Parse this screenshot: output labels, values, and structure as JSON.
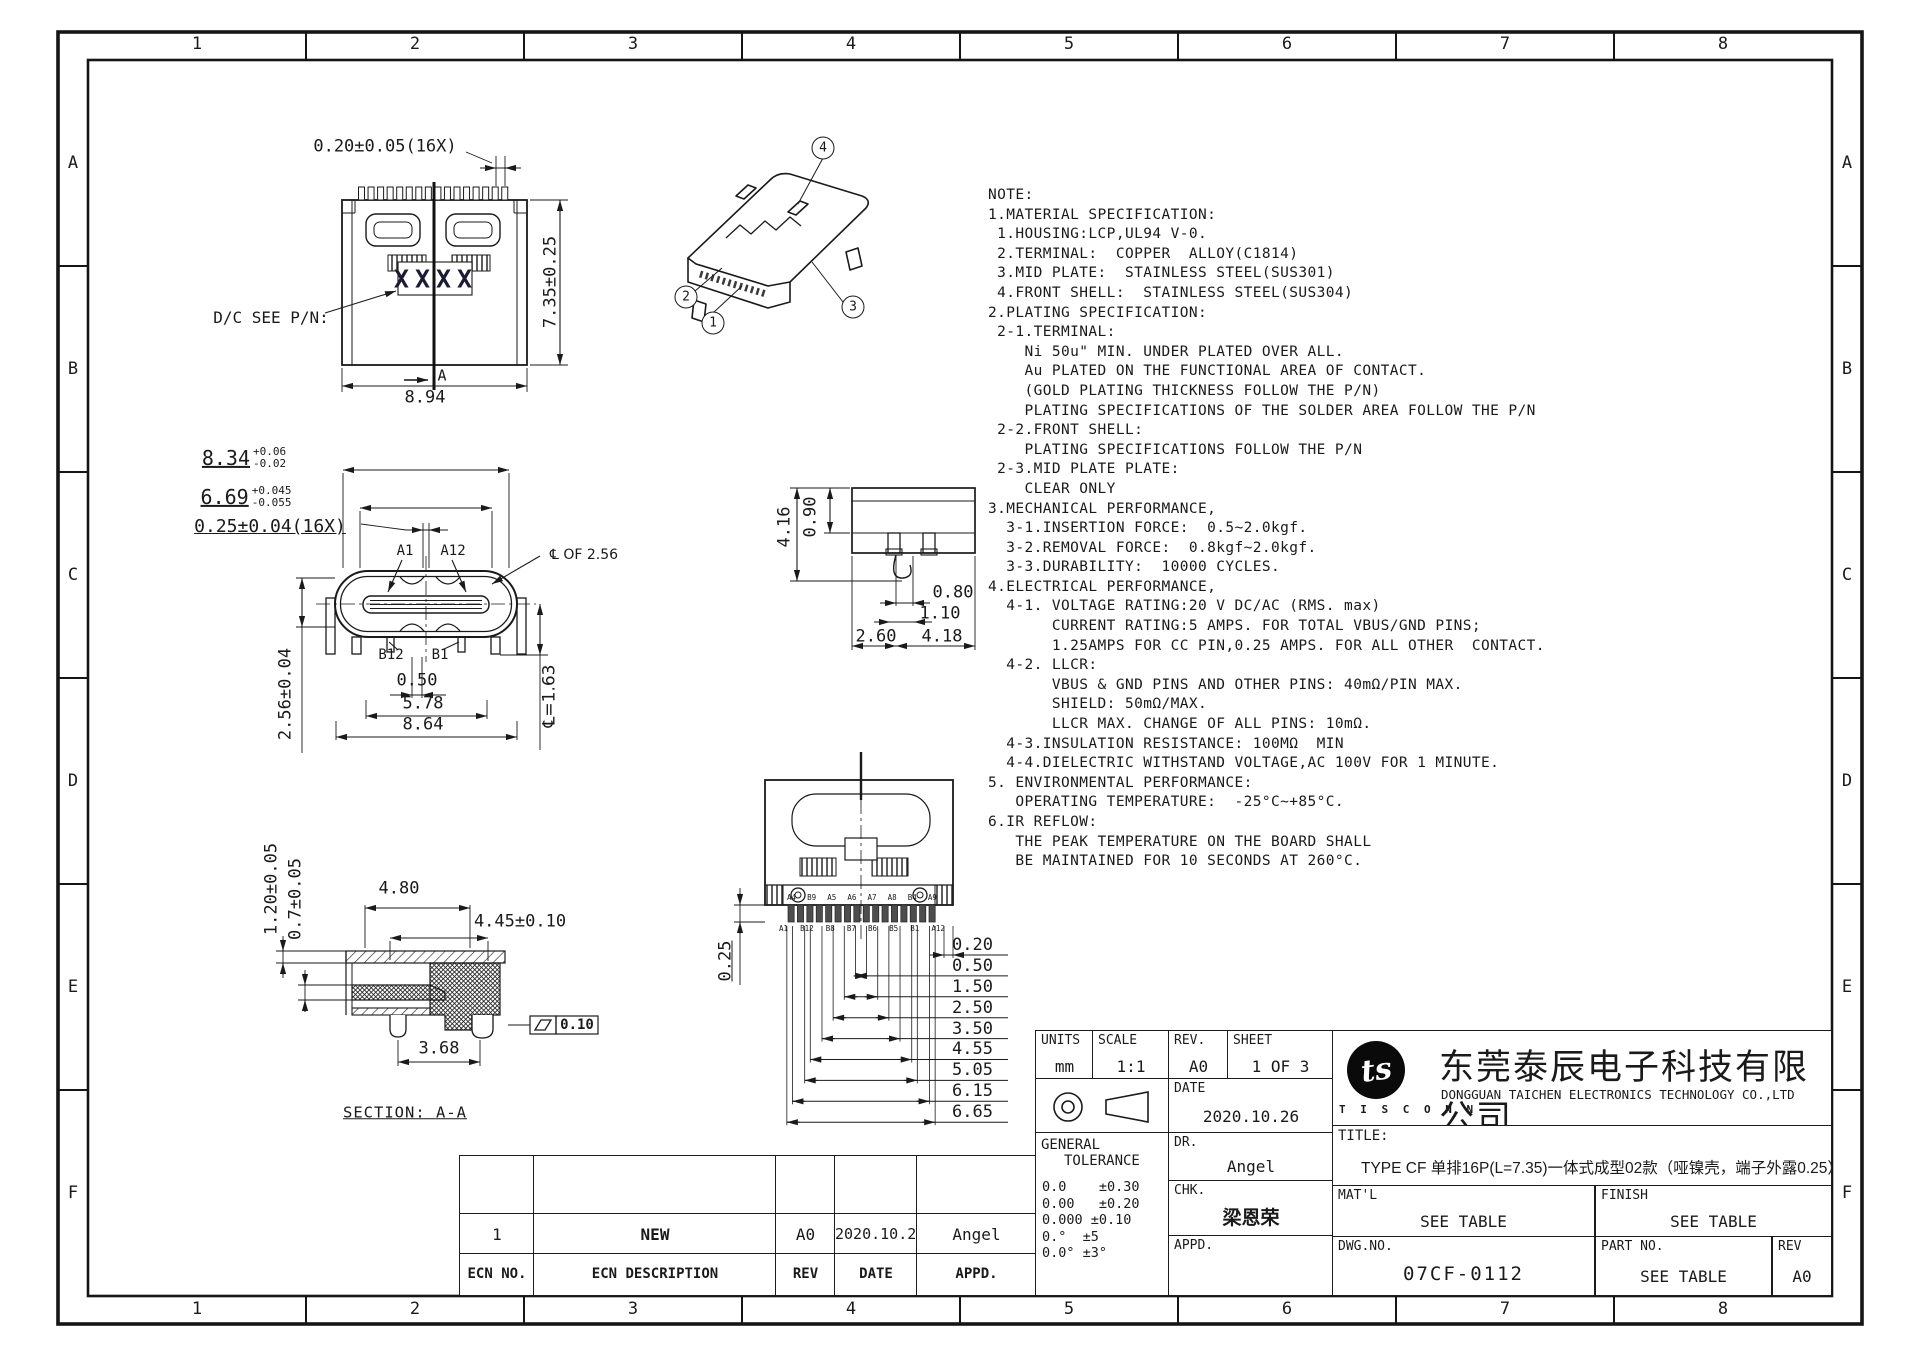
{
  "frame": {
    "cols": [
      "1",
      "2",
      "3",
      "4",
      "5",
      "6",
      "7",
      "8"
    ],
    "rows": [
      "A",
      "B",
      "C",
      "D",
      "E",
      "F"
    ]
  },
  "notes": {
    "text": "NOTE:\n1.MATERIAL SPECIFICATION:\n 1.HOUSING:LCP,UL94 V-0.\n 2.TERMINAL:  COPPER  ALLOY(C1814)\n 3.MID PLATE:  STAINLESS STEEL(SUS301)\n 4.FRONT SHELL:  STAINLESS STEEL(SUS304)\n2.PLATING SPECIFICATION:\n 2-1.TERMINAL:\n    Ni 50u\" MIN. UNDER PLATED OVER ALL.\n    Au PLATED ON THE FUNCTIONAL AREA OF CONTACT.\n    (GOLD PLATING THICKNESS FOLLOW THE P/N)\n    PLATING SPECIFICATIONS OF THE SOLDER AREA FOLLOW THE P/N\n 2-2.FRONT SHELL:\n    PLATING SPECIFICATIONS FOLLOW THE P/N\n 2-3.MID PLATE PLATE:\n    CLEAR ONLY\n3.MECHANICAL PERFORMANCE,\n  3-1.INSERTION FORCE:  0.5~2.0kgf.\n  3-2.REMOVAL FORCE:  0.8kgf~2.0kgf.\n  3-3.DURABILITY:  10000 CYCLES.\n4.ELECTRICAL PERFORMANCE,\n  4-1. VOLTAGE RATING:20 V DC/AC (RMS. max)\n       CURRENT RATING:5 AMPS. FOR TOTAL VBUS/GND PINS;\n       1.25AMPS FOR CC PIN,0.25 AMPS. FOR ALL OTHER  CONTACT.\n  4-2. LLCR:\n       VBUS & GND PINS AND OTHER PINS: 40mΩ/PIN MAX.\n       SHIELD: 50mΩ/MAX.\n       LLCR MAX. CHANGE OF ALL PINS: 10mΩ.\n  4-3.INSULATION RESISTANCE: 100MΩ  MIN\n  4-4.DIELECTRIC WITHSTAND VOLTAGE,AC 100V FOR 1 MINUTE.\n5. ENVIRONMENTAL PERFORMANCE:\n   OPERATING TEMPERATURE:  -25°C~+85°C.\n6.IR REFLOW:\n   THE PEAK TEMPERATURE ON THE BOARD SHALL\n   BE MAINTAINED FOR 10 SECONDS AT 260°C."
  },
  "views": {
    "top": {
      "dim_pin": "0.20±0.05(16X)",
      "dim_height": "7.35±0.25",
      "dim_width": "8.94",
      "dc": "D/C SEE P/N:",
      "marking": "XXXX",
      "section": "A"
    },
    "front": {
      "w1": "8.34",
      "w1_up": "+0.06",
      "w1_dn": "-0.02",
      "w2": "6.69",
      "w2_up": "+0.045",
      "w2_dn": "-0.055",
      "pin": "0.25±0.04(16X)",
      "a1": "A1",
      "a12": "A12",
      "cl_of": "℄ OF 2.56",
      "b12": "B12",
      "b1": "B1",
      "d050": "0.50",
      "d578": "5.78",
      "d864": "8.64",
      "h": "2.56±0.04",
      "cl163": "℄=1.63"
    },
    "side": {
      "d416": "4.16",
      "d090": "0.90",
      "d080": "0.80",
      "d110": "1.10",
      "d260": "2.60",
      "d418": "4.18"
    },
    "bottom": {
      "d025": "0.25",
      "ladder": [
        "0.20",
        "0.50",
        "1.50",
        "2.50",
        "3.50",
        "4.55",
        "5.05",
        "6.15",
        "6.65"
      ],
      "pins_top": [
        "A4",
        "B9",
        "A5",
        "A6",
        "A7",
        "A8",
        "B4",
        "A9"
      ],
      "pins_bottom": [
        "A1",
        "B12",
        "B8",
        "B7",
        "B6",
        "B5",
        "B1",
        "A12"
      ]
    },
    "section": {
      "d120": "1.20±0.05",
      "d07": "0.7±0.05",
      "d480": "4.80",
      "d445": "4.45±0.10",
      "d368": "3.68",
      "flat": "0.10",
      "label": "SECTION: A-A"
    },
    "iso": {
      "balloons": [
        "1",
        "2",
        "3",
        "4"
      ]
    }
  },
  "ecn": {
    "headers": [
      "ECN NO.",
      "ECN  DESCRIPTION",
      "REV",
      "DATE",
      "APPD."
    ],
    "row": [
      "1",
      "NEW",
      "A0",
      "2020.10.26",
      "Angel"
    ]
  },
  "titleblock": {
    "units_label": "UNITS",
    "units": "mm",
    "scale_label": "SCALE",
    "scale": "1:1",
    "rev_label": "REV.",
    "rev": "A0",
    "sheet_label": "SHEET",
    "sheet": "1 OF 3",
    "date_label": "DATE",
    "date": "2020.10.26",
    "dr_label": "DR.",
    "dr": "Angel",
    "chk_label": "CHK.",
    "chk": "梁恩荣",
    "appd_label": "APPD.",
    "gt_line1": "GENERAL",
    "gt_line2": "TOLERANCE",
    "tols": "0.0    ±0.30\n0.00   ±0.20\n0.000 ±0.10\n0.°  ±5\n0.0° ±3°",
    "logo_text": "ts",
    "logo_sub": "T I S C O N N",
    "company_cn": "东莞泰辰电子科技有限公司",
    "company_en": "DONGGUAN  TAICHEN  ELECTRONICS  TECHNOLOGY  CO.,LTD",
    "title_label": "TITLE:",
    "title": "TYPE CF 单排16P(L=7.35)一体式成型02款（哑镍壳，端子外露0.25）",
    "matl_label": "MAT'L",
    "matl": "SEE  TABLE",
    "finish_label": "FINISH",
    "finish": "SEE  TABLE",
    "dwg_label": "DWG.NO.",
    "dwg": "07CF-0112",
    "part_label": "PART  NO.",
    "part": "SEE  TABLE",
    "rev2_label": "REV",
    "rev2": "A0"
  }
}
